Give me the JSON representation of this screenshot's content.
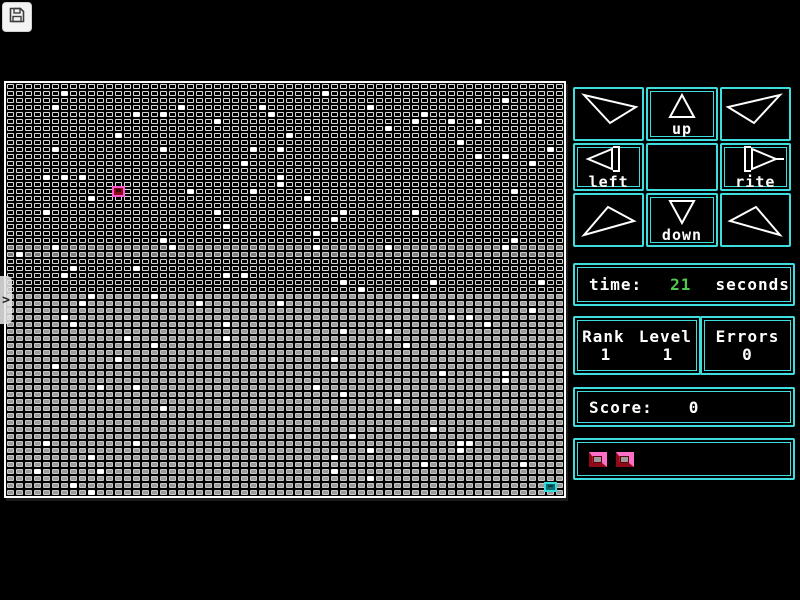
{
  "colors": {
    "accent": "#3fdede",
    "text": "#ffffff",
    "time_value_color": "#4ec94e",
    "player_border": "#ff55cc",
    "player_fill": "#8c0d18",
    "goal_border": "#35dcdc",
    "goal_fill": "#0b6b70"
  },
  "toolbar": {
    "save_icon": "floppy-disk"
  },
  "drawer": {
    "icon": ">"
  },
  "board": {
    "cols": 62,
    "rows": 59,
    "row_bands": [
      {
        "until": 23,
        "fill": "#000000",
        "outline": "#d8d8d8"
      },
      {
        "until": 25,
        "fill": "#7a7a7a",
        "outline": "#cfcfcf"
      },
      {
        "until": 30,
        "fill": "#060606",
        "outline": "#d6d6d6"
      },
      {
        "until": 59,
        "fill": "#9a9a9a",
        "outline": "#c9c9c9"
      }
    ],
    "white_cells": [
      [
        6,
        1
      ],
      [
        5,
        3
      ],
      [
        14,
        4
      ],
      [
        17,
        4
      ],
      [
        19,
        3
      ],
      [
        12,
        7
      ],
      [
        17,
        9
      ],
      [
        5,
        9
      ],
      [
        4,
        13
      ],
      [
        6,
        13
      ],
      [
        8,
        13
      ],
      [
        9,
        16
      ],
      [
        20,
        15
      ],
      [
        4,
        18
      ],
      [
        35,
        1
      ],
      [
        40,
        3
      ],
      [
        28,
        3
      ],
      [
        23,
        5
      ],
      [
        29,
        4
      ],
      [
        42,
        6
      ],
      [
        31,
        7
      ],
      [
        30,
        9
      ],
      [
        27,
        9
      ],
      [
        26,
        11
      ],
      [
        30,
        13
      ],
      [
        30,
        14
      ],
      [
        27,
        15
      ],
      [
        33,
        16
      ],
      [
        23,
        18
      ],
      [
        37,
        18
      ],
      [
        36,
        19
      ],
      [
        55,
        2
      ],
      [
        46,
        4
      ],
      [
        45,
        5
      ],
      [
        49,
        5
      ],
      [
        52,
        5
      ],
      [
        50,
        8
      ],
      [
        52,
        10
      ],
      [
        55,
        10
      ],
      [
        60,
        9
      ],
      [
        58,
        11
      ],
      [
        56,
        15
      ],
      [
        45,
        18
      ],
      [
        1,
        24
      ],
      [
        17,
        22
      ],
      [
        18,
        23
      ],
      [
        5,
        23
      ],
      [
        6,
        27
      ],
      [
        7,
        26
      ],
      [
        14,
        26
      ],
      [
        8,
        31
      ],
      [
        9,
        30
      ],
      [
        16,
        30
      ],
      [
        21,
        31
      ],
      [
        6,
        33
      ],
      [
        7,
        34
      ],
      [
        13,
        36
      ],
      [
        16,
        37
      ],
      [
        12,
        39
      ],
      [
        24,
        20
      ],
      [
        34,
        21
      ],
      [
        34,
        23
      ],
      [
        24,
        27
      ],
      [
        26,
        27
      ],
      [
        37,
        28
      ],
      [
        39,
        29
      ],
      [
        30,
        31
      ],
      [
        24,
        34
      ],
      [
        37,
        35
      ],
      [
        24,
        36
      ],
      [
        36,
        39
      ],
      [
        42,
        23
      ],
      [
        56,
        22
      ],
      [
        55,
        23
      ],
      [
        47,
        28
      ],
      [
        59,
        28
      ],
      [
        45,
        30
      ],
      [
        51,
        33
      ],
      [
        49,
        33
      ],
      [
        53,
        34
      ],
      [
        58,
        32
      ],
      [
        42,
        35
      ],
      [
        44,
        37
      ],
      [
        5,
        40
      ],
      [
        10,
        43
      ],
      [
        14,
        43
      ],
      [
        17,
        46
      ],
      [
        4,
        51
      ],
      [
        14,
        51
      ],
      [
        9,
        53
      ],
      [
        3,
        55
      ],
      [
        10,
        55
      ],
      [
        7,
        57
      ],
      [
        9,
        58
      ],
      [
        48,
        41
      ],
      [
        55,
        41
      ],
      [
        55,
        42
      ],
      [
        34,
        43
      ],
      [
        37,
        44
      ],
      [
        43,
        45
      ],
      [
        47,
        49
      ],
      [
        38,
        50
      ],
      [
        50,
        51
      ],
      [
        51,
        51
      ],
      [
        50,
        52
      ],
      [
        40,
        52
      ],
      [
        36,
        53
      ],
      [
        46,
        54
      ],
      [
        57,
        54
      ],
      [
        36,
        55
      ],
      [
        40,
        56
      ]
    ],
    "player": {
      "col": 12,
      "row": 15
    },
    "goal": {
      "col": 60,
      "row": 57
    }
  },
  "dpad": {
    "buttons": [
      {
        "id": "up-left",
        "label": ""
      },
      {
        "id": "up",
        "label": "up"
      },
      {
        "id": "up-right",
        "label": ""
      },
      {
        "id": "left",
        "label": "left"
      },
      {
        "id": "center",
        "label": ""
      },
      {
        "id": "right",
        "label": "rite"
      },
      {
        "id": "down-left",
        "label": ""
      },
      {
        "id": "down",
        "label": "down"
      },
      {
        "id": "down-right",
        "label": ""
      }
    ]
  },
  "time": {
    "label": "time:",
    "value": "21",
    "unit": "seconds"
  },
  "rank_level": {
    "rank_label": "Rank",
    "level_label": "Level",
    "rank_value": "1",
    "level_value": "1"
  },
  "errors": {
    "label": "Errors",
    "value": "0"
  },
  "score": {
    "label": "Score:",
    "value": "0"
  },
  "lives": {
    "count": 2
  }
}
